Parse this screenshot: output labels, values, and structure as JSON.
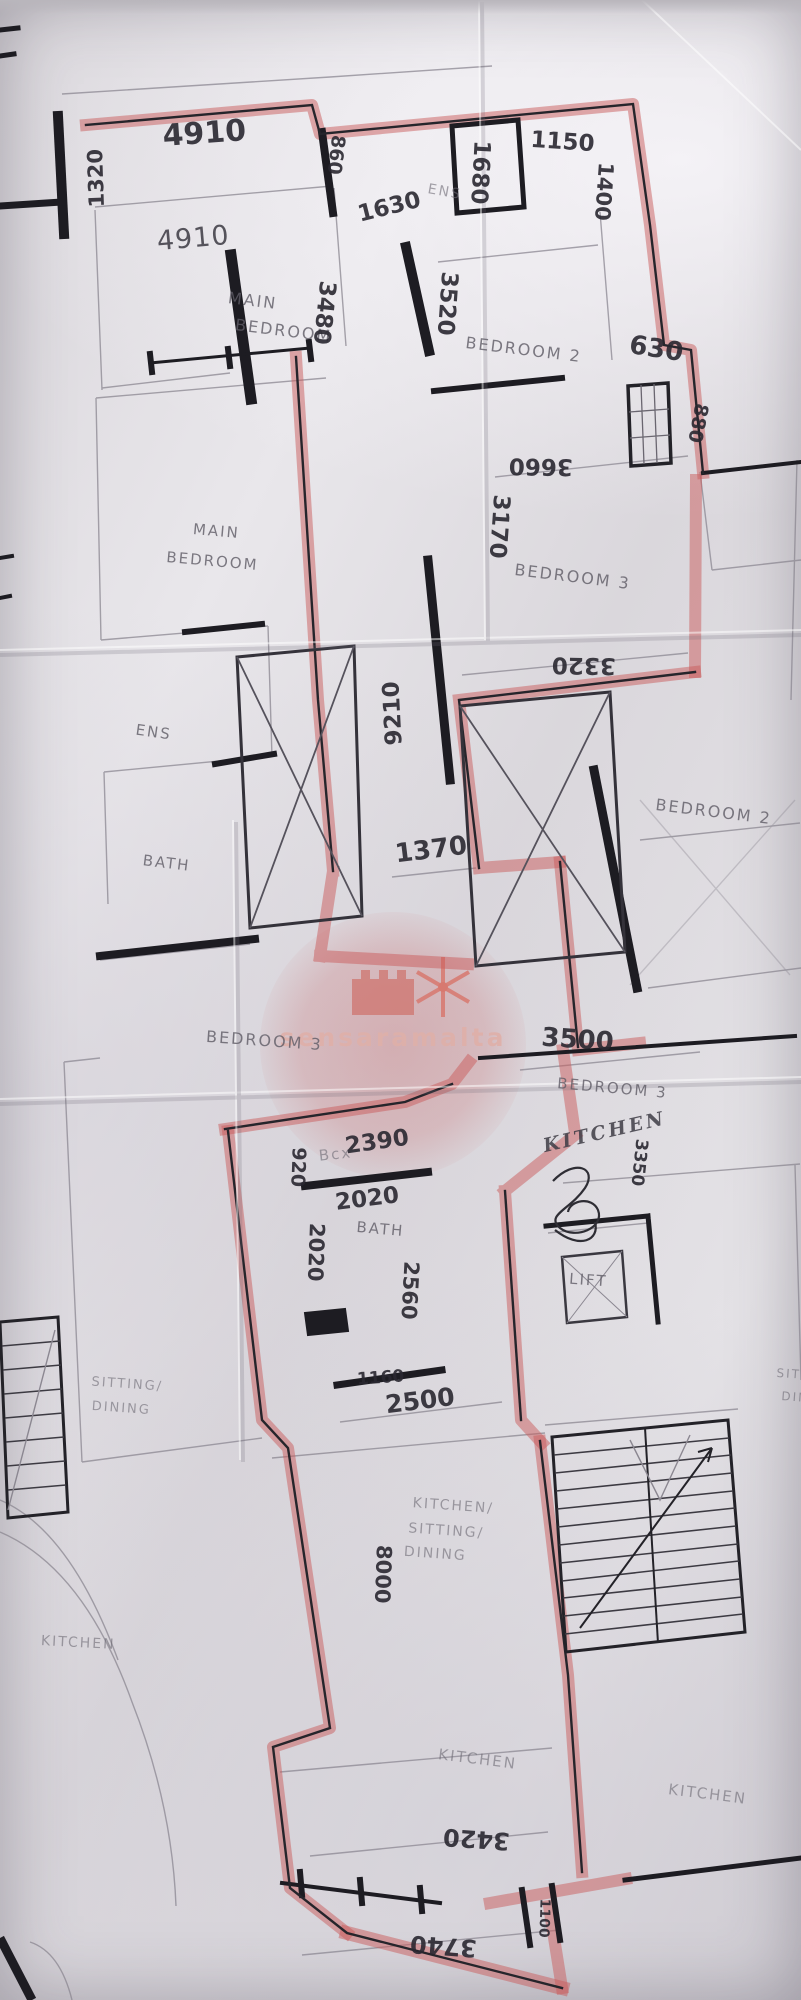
{
  "watermark": {
    "text": "sensaramalta"
  },
  "labels": [
    {
      "id": "dim-4910-top",
      "kind": "dimension",
      "text": "4910",
      "x": 205,
      "y": 143,
      "rot": -4,
      "size": 30,
      "style": "hand"
    },
    {
      "id": "dim-1320",
      "kind": "dimension",
      "text": "1320",
      "x": 103,
      "y": 178,
      "rot": -92,
      "size": 21,
      "style": "hand"
    },
    {
      "id": "dim-860",
      "kind": "dimension",
      "text": "860",
      "x": 330,
      "y": 154,
      "rot": 97,
      "size": 19,
      "style": "hand"
    },
    {
      "id": "dim-1680",
      "kind": "dimension",
      "text": "1680",
      "x": 473,
      "y": 172,
      "rot": 93,
      "size": 23,
      "style": "hand"
    },
    {
      "id": "room-ens-top",
      "kind": "room",
      "text": "ENS",
      "x": 444,
      "y": 196,
      "rot": 10,
      "size": 14,
      "style": "faint"
    },
    {
      "id": "dim-1630",
      "kind": "dimension",
      "text": "1630",
      "x": 391,
      "y": 214,
      "rot": -14,
      "size": 23,
      "style": "hand"
    },
    {
      "id": "dim-1150",
      "kind": "dimension",
      "text": "1150",
      "x": 562,
      "y": 149,
      "rot": 4,
      "size": 23,
      "style": "hand"
    },
    {
      "id": "dim-1400",
      "kind": "dimension",
      "text": "1400",
      "x": 597,
      "y": 191,
      "rot": 94,
      "size": 21,
      "style": "hand"
    },
    {
      "id": "dim-4910-room",
      "kind": "dimension",
      "text": "4910",
      "x": 194,
      "y": 247,
      "rot": -5,
      "size": 27,
      "style": "hand2"
    },
    {
      "id": "room-main-bedroom-1-l1",
      "kind": "room",
      "text": "MAIN",
      "x": 252,
      "y": 306,
      "rot": 7,
      "size": 16,
      "style": "print"
    },
    {
      "id": "room-main-bedroom-1-l2",
      "kind": "room",
      "text": "BEDROOM",
      "x": 283,
      "y": 336,
      "rot": 7,
      "size": 16,
      "style": "print"
    },
    {
      "id": "dim-3480",
      "kind": "dimension",
      "text": "3480",
      "x": 317,
      "y": 312,
      "rot": 96,
      "size": 23,
      "style": "hand"
    },
    {
      "id": "dim-3520",
      "kind": "dimension",
      "text": "3520",
      "x": 440,
      "y": 303,
      "rot": 94,
      "size": 23,
      "style": "hand"
    },
    {
      "id": "room-bedroom2-top",
      "kind": "room",
      "text": "BEDROOM  2",
      "x": 523,
      "y": 355,
      "rot": 7,
      "size": 16,
      "style": "print"
    },
    {
      "id": "dim-630",
      "kind": "dimension",
      "text": "630",
      "x": 655,
      "y": 357,
      "rot": 9,
      "size": 26,
      "style": "hand"
    },
    {
      "id": "dim-880",
      "kind": "dimension",
      "text": "880",
      "x": 692,
      "y": 422,
      "rot": 101,
      "size": 19,
      "style": "hand"
    },
    {
      "id": "dim-3660",
      "kind": "dimension",
      "text": "3660",
      "x": 541,
      "y": 459,
      "rot": 181,
      "size": 23,
      "style": "hand"
    },
    {
      "id": "dim-3170",
      "kind": "dimension",
      "text": "3170",
      "x": 492,
      "y": 526,
      "rot": 94,
      "size": 23,
      "style": "hand"
    },
    {
      "id": "room-main-bedroom-2-l1",
      "kind": "room",
      "text": "MAIN",
      "x": 216,
      "y": 536,
      "rot": 5,
      "size": 15,
      "style": "print"
    },
    {
      "id": "room-main-bedroom-2-l2",
      "kind": "room",
      "text": "BEDROOM",
      "x": 212,
      "y": 566,
      "rot": 5,
      "size": 15,
      "style": "print"
    },
    {
      "id": "room-bedroom3-mid",
      "kind": "room",
      "text": "BEDROOM  3",
      "x": 572,
      "y": 582,
      "rot": 7,
      "size": 16,
      "style": "print"
    },
    {
      "id": "dim-3320",
      "kind": "dimension",
      "text": "3320",
      "x": 584,
      "y": 658,
      "rot": 181,
      "size": 23,
      "style": "hand"
    },
    {
      "id": "dim-9210",
      "kind": "dimension",
      "text": "9210",
      "x": 400,
      "y": 713,
      "rot": -93,
      "size": 23,
      "style": "hand"
    },
    {
      "id": "room-ens-left",
      "kind": "room",
      "text": "ENS",
      "x": 153,
      "y": 737,
      "rot": 8,
      "size": 15,
      "style": "print"
    },
    {
      "id": "room-bedroom2-right",
      "kind": "room",
      "text": "BEDROOM  2",
      "x": 713,
      "y": 817,
      "rot": 7,
      "size": 16,
      "style": "print"
    },
    {
      "id": "room-bath-left",
      "kind": "room",
      "text": "BATH",
      "x": 166,
      "y": 868,
      "rot": 7,
      "size": 15,
      "style": "print"
    },
    {
      "id": "dim-1370",
      "kind": "dimension",
      "text": "1370",
      "x": 432,
      "y": 858,
      "rot": -7,
      "size": 26,
      "style": "hand"
    },
    {
      "id": "room-bedroom3-left",
      "kind": "room",
      "text": "BEDROOM  3",
      "x": 264,
      "y": 1046,
      "rot": 4,
      "size": 16,
      "style": "print"
    },
    {
      "id": "dim-3500",
      "kind": "dimension",
      "text": "3500",
      "x": 577,
      "y": 1048,
      "rot": 4,
      "size": 26,
      "style": "hand"
    },
    {
      "id": "room-bedroom3-right",
      "kind": "room",
      "text": "BEDROOM  3",
      "x": 612,
      "y": 1093,
      "rot": 5,
      "size": 15,
      "style": "print"
    },
    {
      "id": "room-kitchen-script",
      "kind": "room",
      "text": "KITCHEN",
      "x": 606,
      "y": 1138,
      "rot": -13,
      "size": 19,
      "style": "script"
    },
    {
      "id": "dim-3350",
      "kind": "dimension",
      "text": "3350",
      "x": 634,
      "y": 1162,
      "rot": 96,
      "size": 17,
      "style": "hand"
    },
    {
      "id": "dim-920",
      "kind": "dimension",
      "text": "920",
      "x": 292,
      "y": 1167,
      "rot": 92,
      "size": 19,
      "style": "hand"
    },
    {
      "id": "note-bcx",
      "kind": "note",
      "text": "Bcx",
      "x": 336,
      "y": 1159,
      "rot": -6,
      "size": 15,
      "style": "faint"
    },
    {
      "id": "dim-2390",
      "kind": "dimension",
      "text": "2390",
      "x": 378,
      "y": 1149,
      "rot": -8,
      "size": 23,
      "style": "hand"
    },
    {
      "id": "dim-2020-h",
      "kind": "dimension",
      "text": "2020",
      "x": 368,
      "y": 1206,
      "rot": -7,
      "size": 23,
      "style": "hand"
    },
    {
      "id": "room-bath-mid",
      "kind": "room",
      "text": "BATH",
      "x": 380,
      "y": 1234,
      "rot": 5,
      "size": 15,
      "style": "print"
    },
    {
      "id": "dim-2020-v",
      "kind": "dimension",
      "text": "2020",
      "x": 309,
      "y": 1252,
      "rot": 92,
      "size": 21,
      "style": "hand"
    },
    {
      "id": "dim-2560",
      "kind": "dimension",
      "text": "2560",
      "x": 403,
      "y": 1290,
      "rot": 93,
      "size": 21,
      "style": "hand"
    },
    {
      "id": "room-lift",
      "kind": "room",
      "text": "LIFT",
      "x": 588,
      "y": 1285,
      "rot": 4,
      "size": 15,
      "style": "print"
    },
    {
      "id": "dim-1160",
      "kind": "dimension",
      "text": "1160",
      "x": 381,
      "y": 1383,
      "rot": -4,
      "size": 17,
      "style": "hand"
    },
    {
      "id": "dim-2500",
      "kind": "dimension",
      "text": "2500",
      "x": 421,
      "y": 1409,
      "rot": -7,
      "size": 25,
      "style": "hand"
    },
    {
      "id": "room-sitting-dining-left-l1",
      "kind": "room",
      "text": "SITTING/",
      "x": 127,
      "y": 1388,
      "rot": 4,
      "size": 13,
      "style": "faint"
    },
    {
      "id": "room-sitting-dining-left-l2",
      "kind": "room",
      "text": "DINING",
      "x": 121,
      "y": 1412,
      "rot": 4,
      "size": 13,
      "style": "faint"
    },
    {
      "id": "room-sitting-right-l1",
      "kind": "room",
      "text": "SITT",
      "x": 793,
      "y": 1378,
      "rot": 4,
      "size": 12,
      "style": "faint"
    },
    {
      "id": "room-sitting-right-l2",
      "kind": "room",
      "text": "DIN",
      "x": 795,
      "y": 1401,
      "rot": 4,
      "size": 12,
      "style": "faint"
    },
    {
      "id": "room-kitchen-sitting-dining-l1",
      "kind": "room",
      "text": "KITCHEN/",
      "x": 453,
      "y": 1510,
      "rot": 4,
      "size": 14,
      "style": "faint"
    },
    {
      "id": "room-kitchen-sitting-dining-l2",
      "kind": "room",
      "text": "SITTING/",
      "x": 446,
      "y": 1535,
      "rot": 4,
      "size": 14,
      "style": "faint"
    },
    {
      "id": "room-kitchen-sitting-dining-l3",
      "kind": "room",
      "text": "DINING",
      "x": 435,
      "y": 1558,
      "rot": 4,
      "size": 14,
      "style": "faint"
    },
    {
      "id": "dim-8000",
      "kind": "dimension",
      "text": "8000",
      "x": 376,
      "y": 1574,
      "rot": 92,
      "size": 21,
      "style": "hand"
    },
    {
      "id": "room-kitchen-left",
      "kind": "room",
      "text": "KITCHEN",
      "x": 78,
      "y": 1647,
      "rot": 3,
      "size": 14,
      "style": "faint"
    },
    {
      "id": "room-kitchen-mid",
      "kind": "room",
      "text": "KITCHEN",
      "x": 477,
      "y": 1764,
      "rot": 7,
      "size": 15,
      "style": "faint"
    },
    {
      "id": "room-kitchen-right",
      "kind": "room",
      "text": "KITCHEN",
      "x": 707,
      "y": 1799,
      "rot": 7,
      "size": 15,
      "style": "faint"
    },
    {
      "id": "dim-3420",
      "kind": "dimension",
      "text": "3420",
      "x": 477,
      "y": 1831,
      "rot": 184,
      "size": 24,
      "style": "hand"
    },
    {
      "id": "dim-3740",
      "kind": "dimension",
      "text": "3740",
      "x": 444,
      "y": 1938,
      "rot": 184,
      "size": 24,
      "style": "hand"
    },
    {
      "id": "dim-1100",
      "kind": "dimension",
      "text": "1100",
      "x": 540,
      "y": 1918,
      "rot": 92,
      "size": 14,
      "style": "hand"
    }
  ]
}
